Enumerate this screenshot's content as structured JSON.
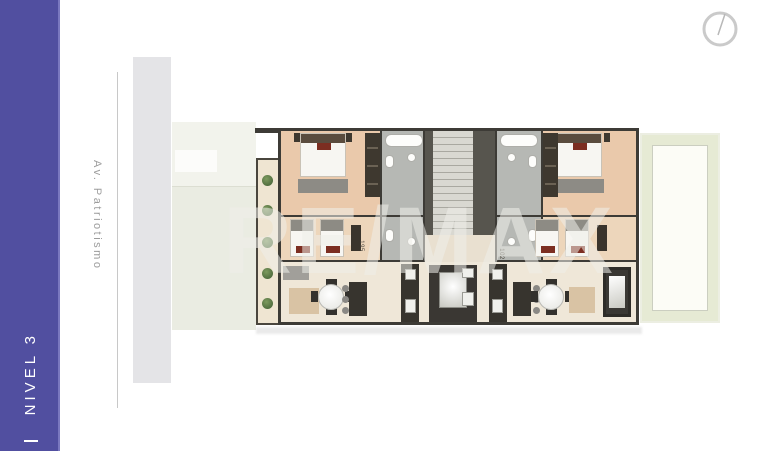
{
  "colors": {
    "accent": "#514fa0",
    "wall": "#3d3b36",
    "floor_peach": "#ecd8c2",
    "bath_gray": "#b6b8b4",
    "terrace_green": "#e6ead4",
    "pillow_maroon": "#7c2e21"
  },
  "sidebar": {
    "level_label": "NIVEL 3"
  },
  "street": {
    "name": "Av. Patriotismo"
  },
  "watermark": {
    "brand": "RE/MAX"
  },
  "floor_plan": {
    "unit_labels": [
      {
        "text": "195"
      },
      {
        "text": "102"
      }
    ]
  },
  "compass": {
    "icon": "north-compass-icon"
  }
}
